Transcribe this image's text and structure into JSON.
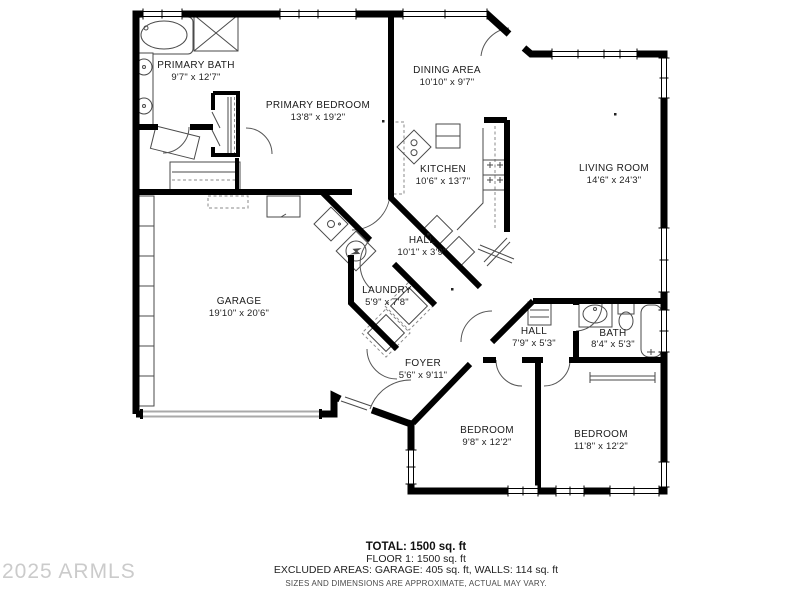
{
  "floorplan": {
    "rooms": [
      {
        "id": "primary-bath",
        "name": "PRIMARY BATH",
        "dims": "9'7\" x 12'7\""
      },
      {
        "id": "primary-bedroom",
        "name": "PRIMARY BEDROOM",
        "dims": "13'8\" x 19'2\""
      },
      {
        "id": "dining-area",
        "name": "DINING AREA",
        "dims": "10'10\" x 9'7\""
      },
      {
        "id": "kitchen",
        "name": "KITCHEN",
        "dims": "10'6\" x 13'7\""
      },
      {
        "id": "living-room",
        "name": "LIVING ROOM",
        "dims": "14'6\" x 24'3\""
      },
      {
        "id": "hall-center",
        "name": "HALL",
        "dims": "10'1\" x 3'9\""
      },
      {
        "id": "laundry",
        "name": "LAUNDRY",
        "dims": "5'9\" x 7'8\""
      },
      {
        "id": "garage",
        "name": "GARAGE",
        "dims": "19'10\" x 20'6\""
      },
      {
        "id": "foyer",
        "name": "FOYER",
        "dims": "5'6\" x 9'11\""
      },
      {
        "id": "hall-rear",
        "name": "HALL",
        "dims": "7'9\" x 5'3\""
      },
      {
        "id": "bath",
        "name": "BATH",
        "dims": "8'4\" x 5'3\""
      },
      {
        "id": "bedroom-middle",
        "name": "BEDROOM",
        "dims": "9'8\" x 12'2\""
      },
      {
        "id": "bedroom-right",
        "name": "BEDROOM",
        "dims": "11'8\" x 12'2\""
      }
    ],
    "summary": {
      "total": "TOTAL: 1500 sq. ft",
      "floor": "FLOOR 1: 1500 sq. ft",
      "excluded": "EXCLUDED AREAS: GARAGE: 405 sq. ft, WALLS: 114 sq. ft",
      "disclaimer": "SIZES AND DIMENSIONS ARE APPROXIMATE, ACTUAL MAY VARY."
    },
    "watermark": "2025 ARMLS",
    "colors": {
      "walls": "#000000",
      "fixtures": "#4a4a4a",
      "garage_door": "#a9a9a9",
      "watermark_text": "#cbcbcb",
      "label_text": "#1b1b1b"
    }
  }
}
